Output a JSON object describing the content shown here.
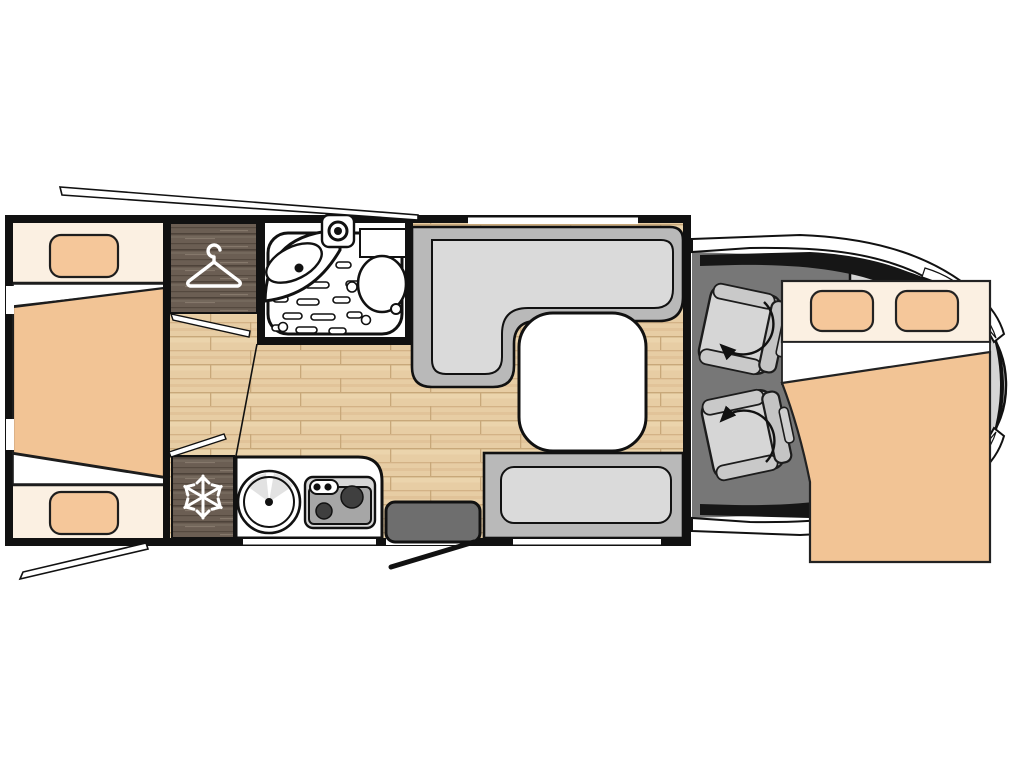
{
  "document": {
    "title": "Motorhome floor plan (top view)",
    "type": "vehicle-floorplan"
  },
  "palette": {
    "wall": "#111111",
    "interior_white": "#ffffff",
    "wood_floor": "#e7cda4",
    "dark_wood": "#6b5e53",
    "mattress_cream": "#fbf0e2",
    "pillow_peach": "#f5c79a",
    "blanket_peach": "#f2c495",
    "bench_gray": "#b9b9b9",
    "cushion_gray": "#dadada",
    "table_white": "#ffffff",
    "cab_floor_gray": "#777777",
    "body_gray": "#d5d5d5",
    "step_gray": "#6e6e6e",
    "seat_gray": "#d6d6d6"
  },
  "floorplan": {
    "vehicle": "motorhome",
    "orientation": "front-of-vehicle-right",
    "areas": [
      {
        "id": "rear-twin-beds",
        "label": "Rear twin single beds with pillows and duvet"
      },
      {
        "id": "wardrobe",
        "label": "Wardrobe",
        "icon": "hanger-icon"
      },
      {
        "id": "refrigerator",
        "label": "Refrigerator",
        "icon": "snowflake-icon"
      },
      {
        "id": "bathroom",
        "label": "Bathroom",
        "fixtures": [
          "shower-tray",
          "washbasin",
          "shower-head",
          "toilet"
        ]
      },
      {
        "id": "kitchen",
        "label": "Kitchen block",
        "fixtures": [
          "round-sink",
          "two-burner-hob"
        ]
      },
      {
        "id": "dinette",
        "label": "L-shaped dinette bench"
      },
      {
        "id": "side-bench",
        "label": "Side bench seat"
      },
      {
        "id": "dining-table",
        "label": "Dining table"
      },
      {
        "id": "entry-door",
        "label": "Entry door with step and swing line"
      },
      {
        "id": "cab",
        "label": "Driver cab with two swivel seats",
        "icon": "rotate-arrow-icon"
      },
      {
        "id": "drop-down-bed",
        "label": "Drop-down double bed over cab with two pillows"
      },
      {
        "id": "open-flaps",
        "label": "Opened window flap markers at rear"
      }
    ]
  }
}
